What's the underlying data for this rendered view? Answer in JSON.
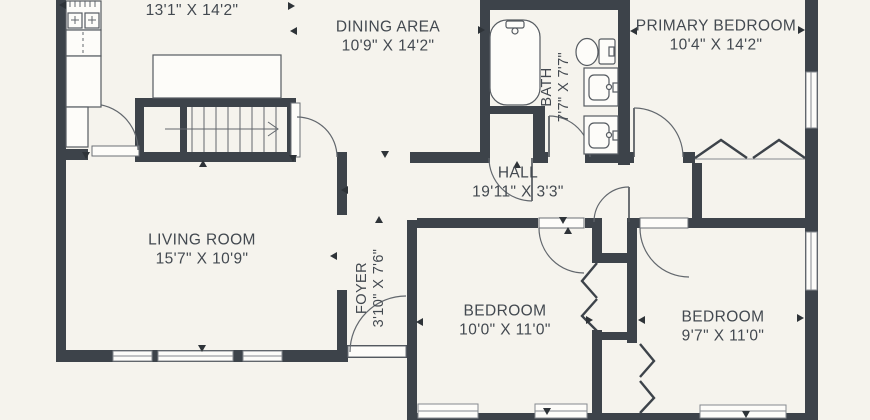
{
  "plan": {
    "kind": "residential-floor-plan",
    "floor_visible_rooms": 9
  },
  "colors": {
    "background": "#f5f3ed",
    "wall": "#3d434a",
    "label_text": "#434950",
    "fixture_stroke": "#565b61"
  },
  "rooms": [
    {
      "key": "kitchen",
      "name": "",
      "dims": "13'1\" X 14'2\""
    },
    {
      "key": "dining_area",
      "name": "DINING AREA",
      "dims": "10'9\" X 14'2\""
    },
    {
      "key": "bath",
      "name": "BATH",
      "dims": "7'7\" X 7'7\""
    },
    {
      "key": "primary_bedroom",
      "name": "PRIMARY BEDROOM",
      "dims": "10'4\" X 14'2\""
    },
    {
      "key": "hall",
      "name": "HALL",
      "dims": "19'11\" X 3'3\""
    },
    {
      "key": "living_room",
      "name": "LIVING ROOM",
      "dims": "15'7\" X 10'9\""
    },
    {
      "key": "foyer",
      "name": "FOYER",
      "dims": "3'10\" X 7'6\""
    },
    {
      "key": "bedroom_middle",
      "name": "BEDROOM",
      "dims": "10'0\" X 11'0\""
    },
    {
      "key": "bedroom_right",
      "name": "BEDROOM",
      "dims": "9'7\" X 11'0\""
    }
  ],
  "fixtures": [
    "range",
    "dishwasher",
    "refrigerator",
    "kitchen-island",
    "staircase",
    "bathtub",
    "toilet",
    "double-vanity-sinks",
    "front-door",
    "bifold-closet-doors",
    "windows"
  ]
}
